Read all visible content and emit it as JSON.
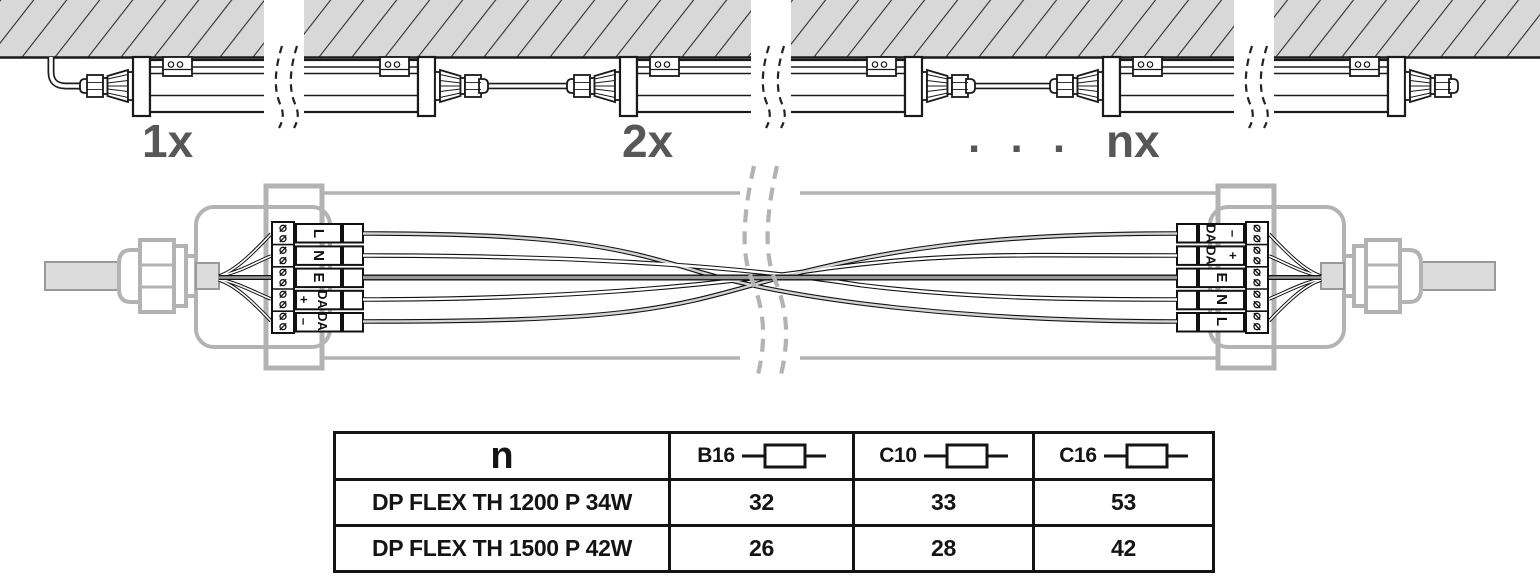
{
  "installation_view": {
    "luminaire_labels": [
      "1x",
      "2x",
      "nx"
    ],
    "ellipsis": ". . ."
  },
  "wiring_view": {
    "left_block": {
      "terminals": [
        {
          "label": "L"
        },
        {
          "label": "N"
        },
        {
          "label": "E"
        },
        {
          "label": "DA",
          "sign": "+"
        },
        {
          "label": "DA",
          "sign": "–"
        }
      ]
    },
    "right_block": {
      "terminals": [
        {
          "label": "DA",
          "sign": "–"
        },
        {
          "label": "DA",
          "sign": "+"
        },
        {
          "label": "E"
        },
        {
          "label": "N"
        },
        {
          "label": "L"
        }
      ]
    }
  },
  "fuse_table": {
    "header_model_col": "n",
    "fuse_ratings": [
      "B16",
      "C10",
      "C16"
    ],
    "rows": [
      {
        "model": "DP FLEX TH 1200 P 34W",
        "max_luminaires": [
          "32",
          "33",
          "53"
        ]
      },
      {
        "model": "DP FLEX TH 1500 P 42W",
        "max_luminaires": [
          "26",
          "28",
          "42"
        ]
      }
    ]
  },
  "colors": {
    "ceiling_fill": "#d8d8d8",
    "hatch_line": "#2f2f2f",
    "drawing_line": "#1a1a1a",
    "grey_outline": "#b3b3b3",
    "label_grey": "#575757",
    "cable_fill": "#dcdcdc",
    "table_border": "#141414"
  }
}
